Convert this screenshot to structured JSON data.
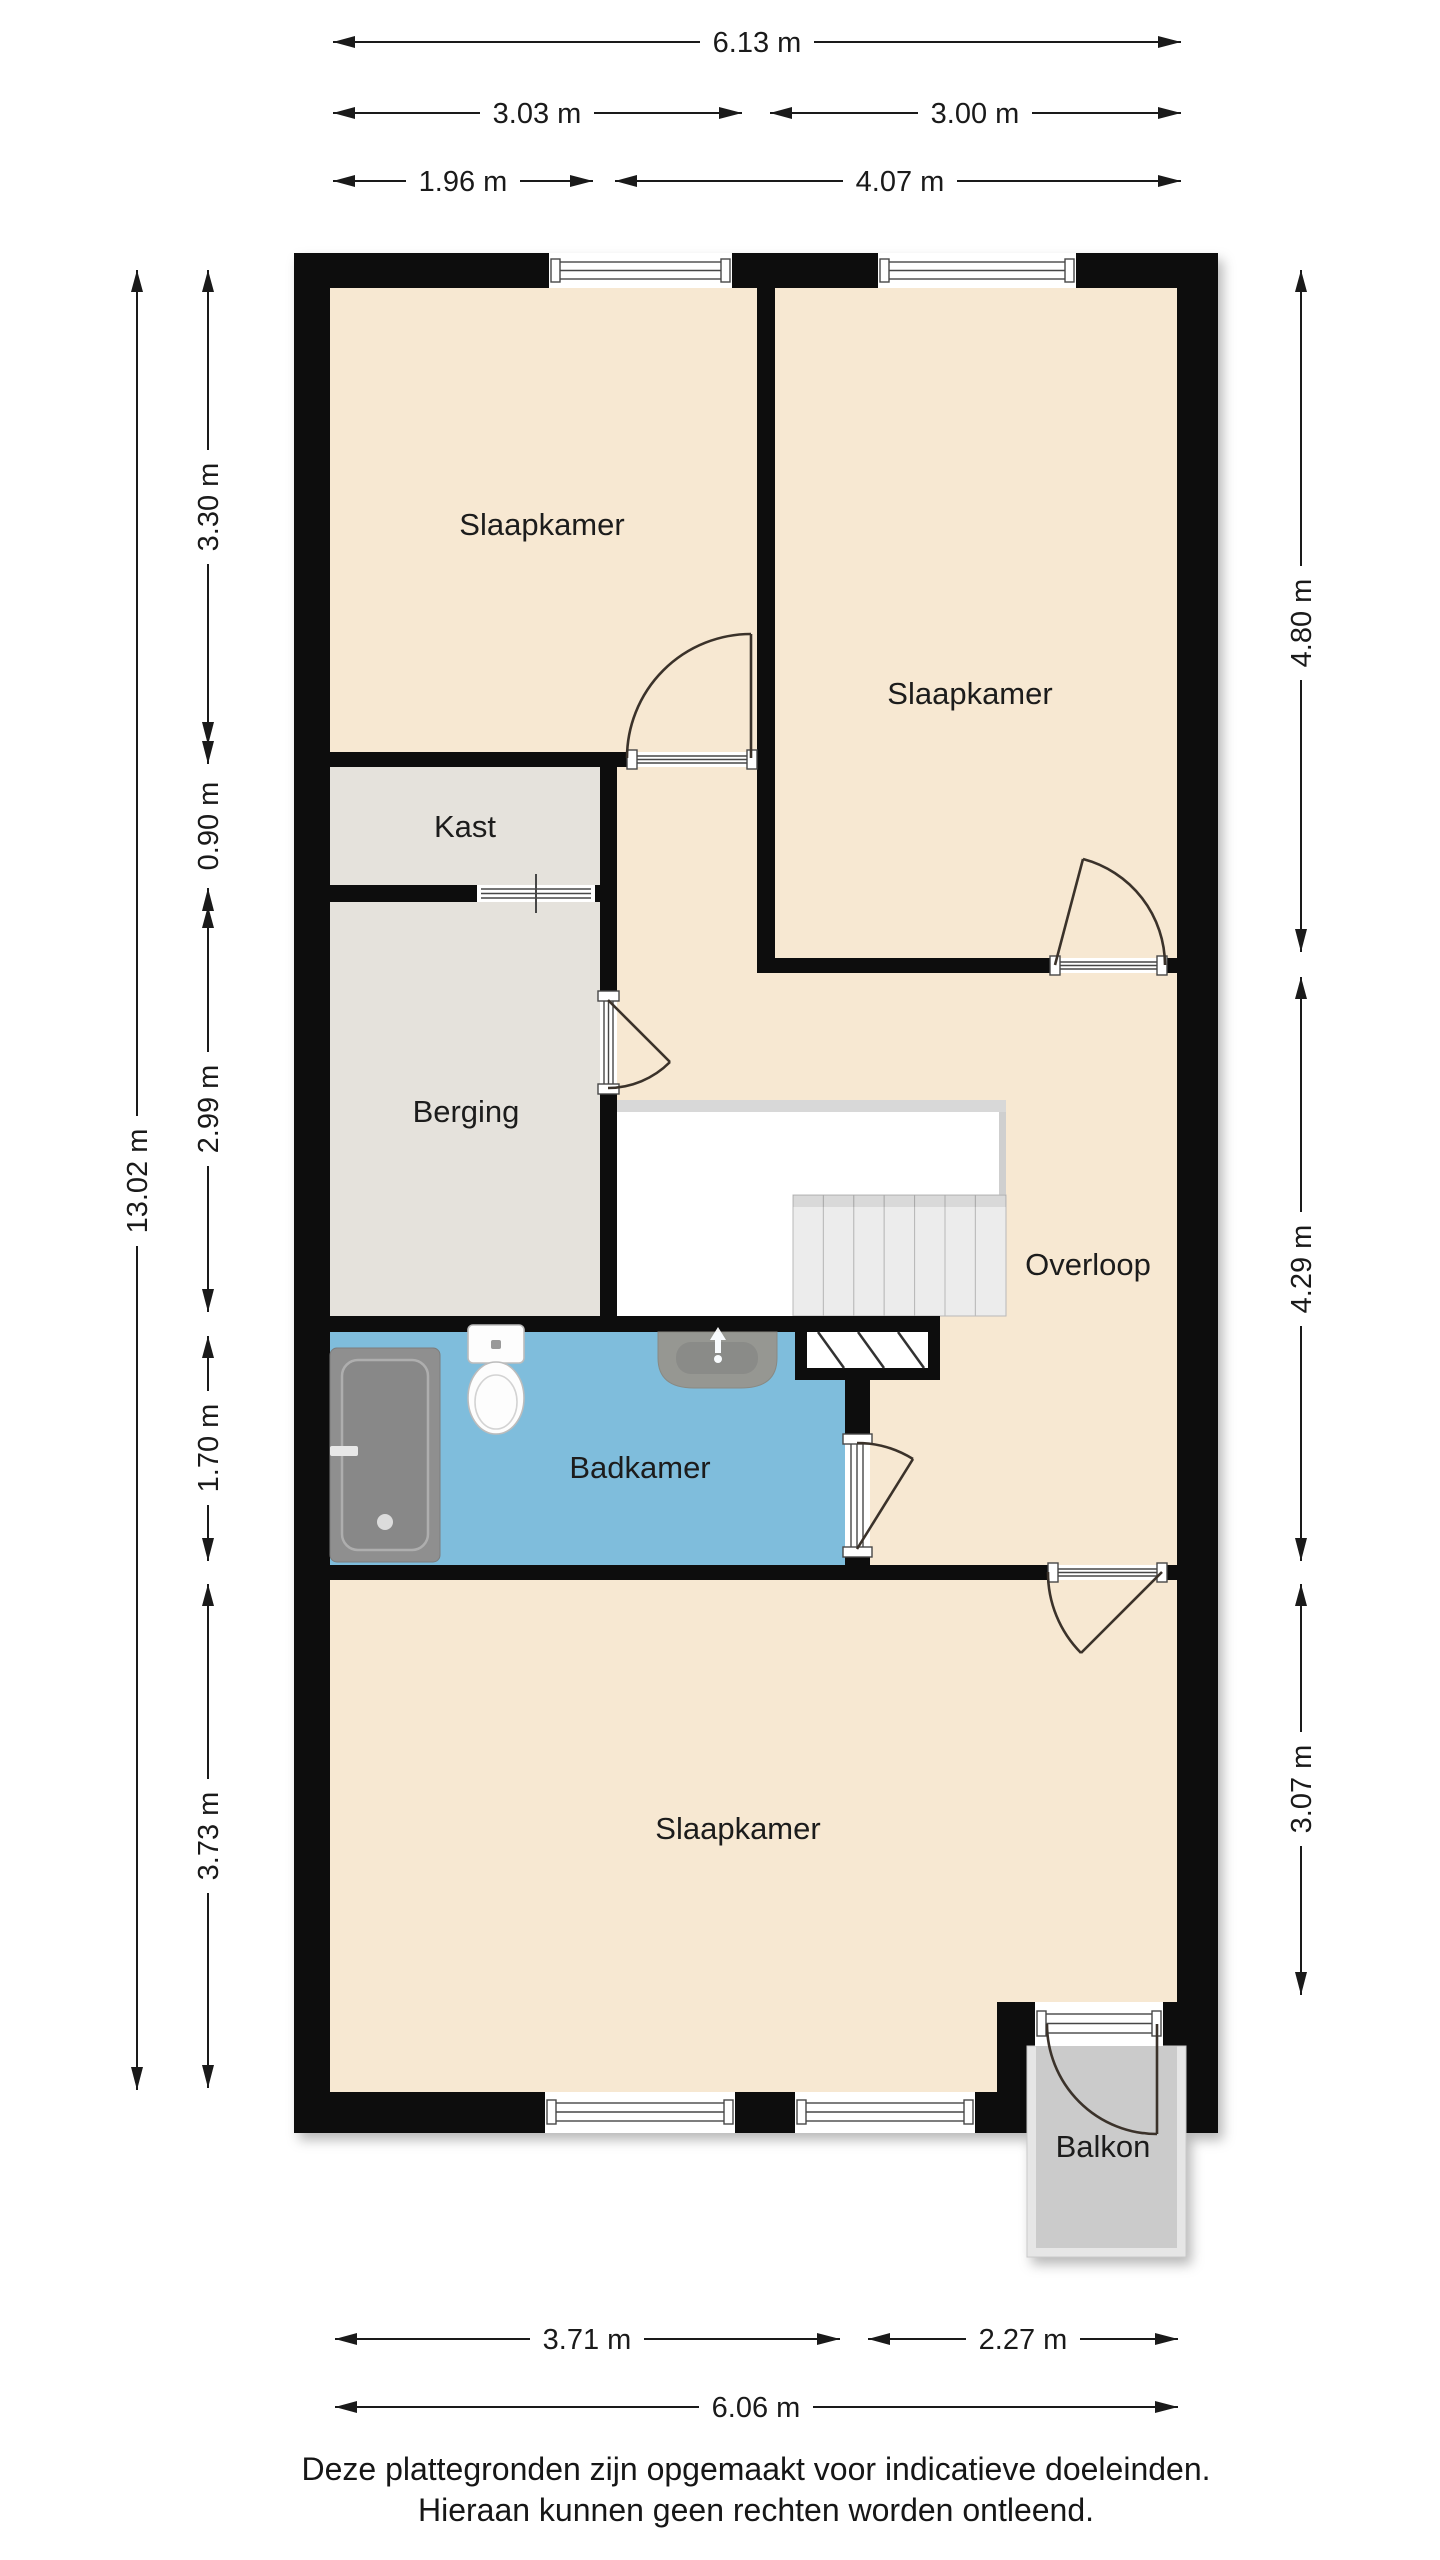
{
  "rooms": {
    "bedroom_top_left": "Slaapkamer",
    "bedroom_top_right": "Slaapkamer",
    "bedroom_bottom": "Slaapkamer",
    "closet": "Kast",
    "storage": "Berging",
    "landing": "Overloop",
    "bathroom": "Badkamer",
    "balcony": "Balkon"
  },
  "dims": {
    "top_total": "6.13 m",
    "top_left": "3.03 m",
    "top_right": "3.00 m",
    "top_inner_left": "1.96 m",
    "top_inner_right": "4.07 m",
    "bottom_left": "3.71 m",
    "bottom_right": "2.27 m",
    "bottom_total": "6.06 m",
    "left_total": "13.02 m",
    "left_seg1": "3.30 m",
    "left_seg2": "0.90 m",
    "left_seg3": "2.99 m",
    "left_seg4": "1.70 m",
    "left_seg5": "3.73 m",
    "right_seg1": "4.80 m",
    "right_seg2": "4.29 m",
    "right_seg3": "3.07 m"
  },
  "disclaimer": {
    "line1": "Deze plattegronden zijn opgemaakt voor indicatieve doeleinden.",
    "line2": "Hieraan kunnen geen rechten worden ontleend."
  },
  "colors": {
    "wall": "#0a0a0a",
    "floor_cream": "#f7e8d2",
    "floor_gray": "#e5e2dc",
    "floor_blue": "#7fbddc",
    "balcony_floor": "#cbcbcb",
    "balcony_rail": "#e6e6e6",
    "stair_tread": "#ececec",
    "stair_band": "#d8d8d8",
    "line_dark": "#1a1a1a",
    "door_stroke": "#3b332b",
    "text": "#1d1d1b"
  }
}
